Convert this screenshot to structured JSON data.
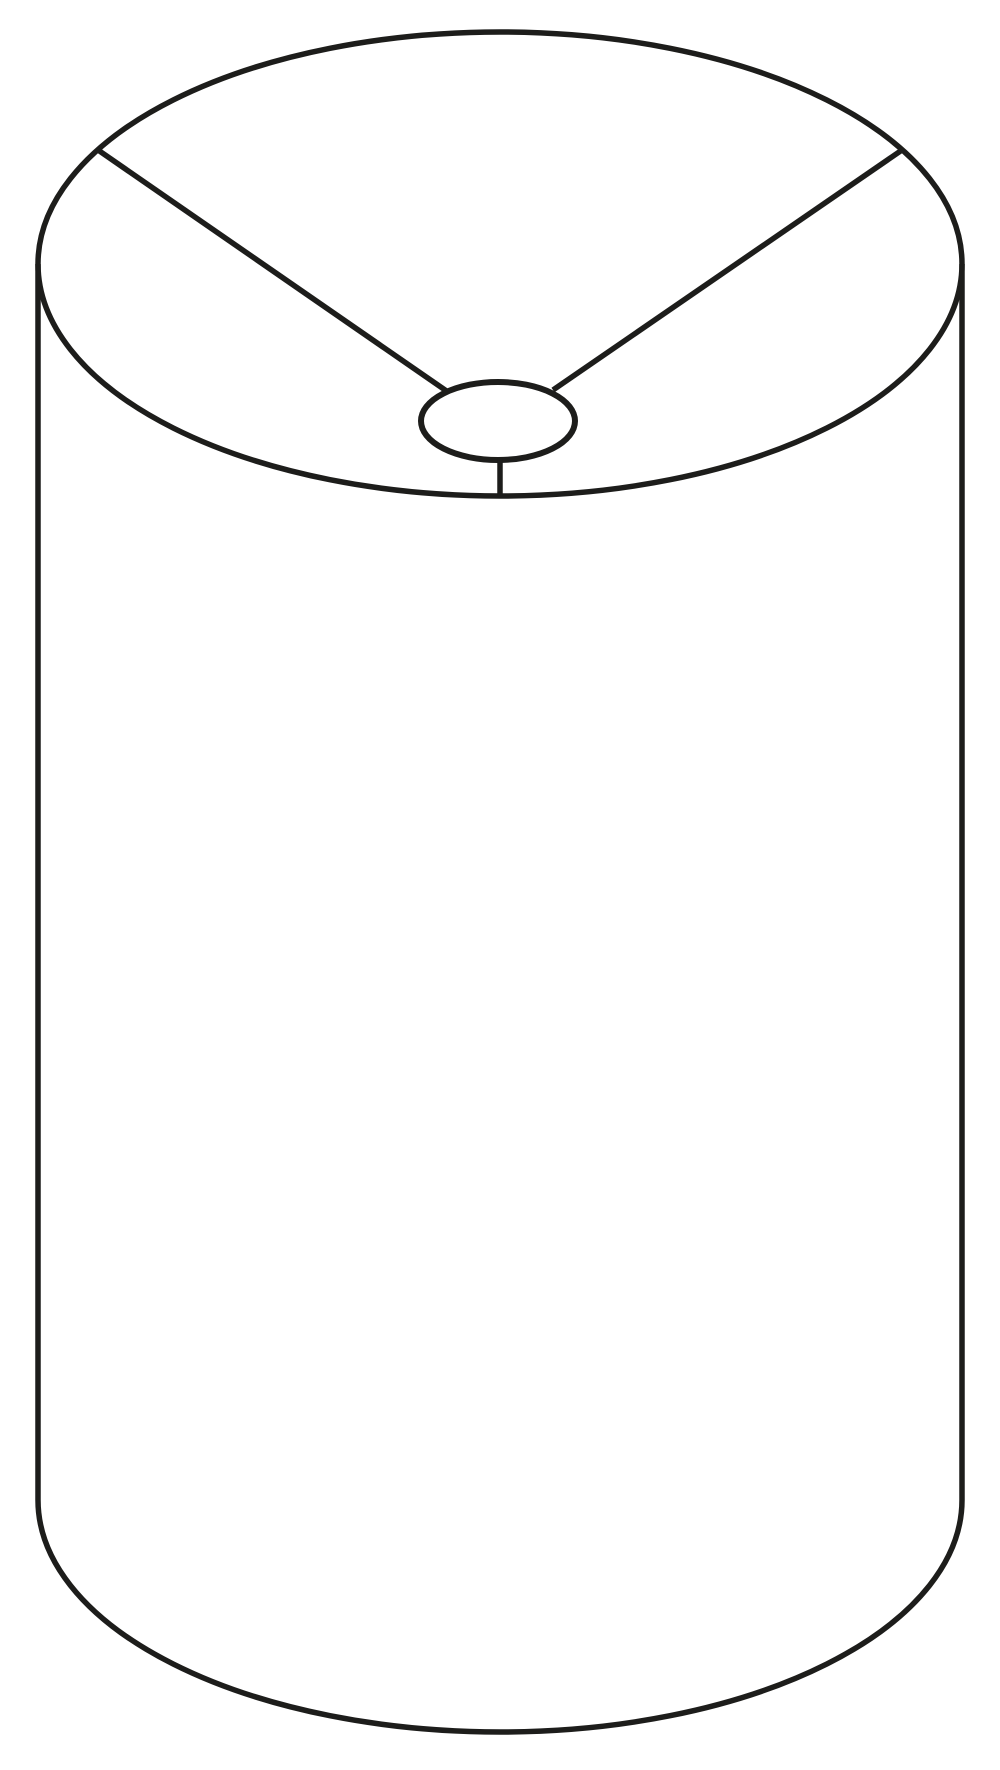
{
  "canvas": {
    "width": 1000,
    "height": 1770,
    "background_color": "#ffffff"
  },
  "drawing": {
    "subject": "drum-lampshade-cylinder-line-drawing",
    "stroke_color": "#1d1d1b",
    "stroke_width": 5.5,
    "fill": "none",
    "shapes": [
      {
        "name": "top-rim-ellipse",
        "type": "ellipse",
        "cx": 500,
        "cy": 264,
        "rx": 462,
        "ry": 232
      },
      {
        "name": "left-side-line",
        "type": "line",
        "x1": 38,
        "y1": 264,
        "x2": 38,
        "y2": 1500
      },
      {
        "name": "right-side-line",
        "type": "line",
        "x1": 962,
        "y1": 264,
        "x2": 962,
        "y2": 1500
      },
      {
        "name": "bottom-rim-arc",
        "type": "arc",
        "rx": 462,
        "ry": 232,
        "start_x": 38,
        "start_y": 1500,
        "end_x": 962,
        "end_y": 1500,
        "large_arc": 0,
        "sweep": 0
      },
      {
        "name": "fitter-ring-ellipse",
        "type": "ellipse",
        "cx": 498,
        "cy": 421,
        "rx": 77,
        "ry": 39,
        "stroke_width": 6
      },
      {
        "name": "fitter-left-spoke",
        "type": "line",
        "x1": 98,
        "y1": 150,
        "x2": 448,
        "y2": 392
      },
      {
        "name": "fitter-right-spoke",
        "type": "line",
        "x1": 902,
        "y1": 150,
        "x2": 553,
        "y2": 390
      },
      {
        "name": "fitter-stem",
        "type": "line",
        "x1": 500,
        "y1": 458,
        "x2": 500,
        "y2": 496
      }
    ]
  }
}
